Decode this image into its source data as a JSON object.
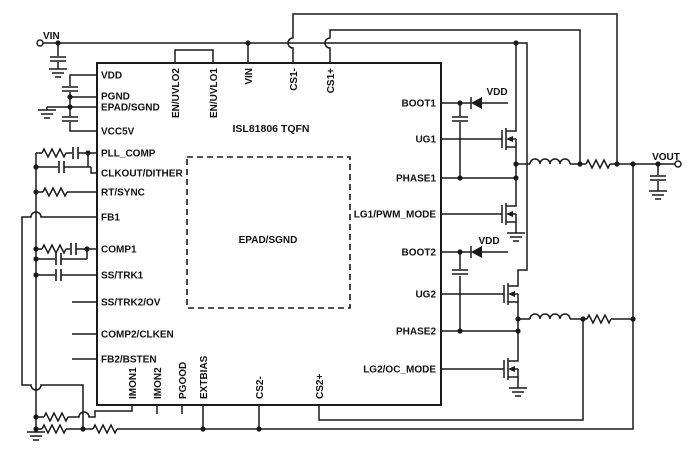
{
  "diagram": {
    "title": "ISL81806 TQFN",
    "epad_label": "EPAD/SGND",
    "pins": {
      "left": [
        "VDD",
        "PGND",
        "EPAD/SGND",
        "VCC5V",
        "PLL_COMP",
        "CLKOUT/DITHER",
        "RT/SYNC",
        "FB1",
        "COMP1",
        "SS/TRK1",
        "SS/TRK2/OV",
        "COMP2/CLKEN",
        "FB2/BSTEN"
      ],
      "top": [
        "EN/UVLO2",
        "EN/UVLO1",
        "VIN",
        "CS1-",
        "CS1+"
      ],
      "right": [
        "BOOT1",
        "UG1",
        "PHASE1",
        "LG1/PWM_MODE",
        "BOOT2",
        "UG2",
        "PHASE2",
        "LG2/OC_MODE"
      ],
      "bottom": [
        "IMON1",
        "IMON2",
        "PGOOD",
        "EXTBIAS",
        "CS2-",
        "CS2+"
      ]
    },
    "nets": {
      "input": "VIN",
      "output": "VOUT",
      "boot1_supply": "VDD",
      "boot2_supply": "VDD"
    },
    "colors": {
      "line": "#1a1a1a",
      "background": "#ffffff"
    }
  }
}
